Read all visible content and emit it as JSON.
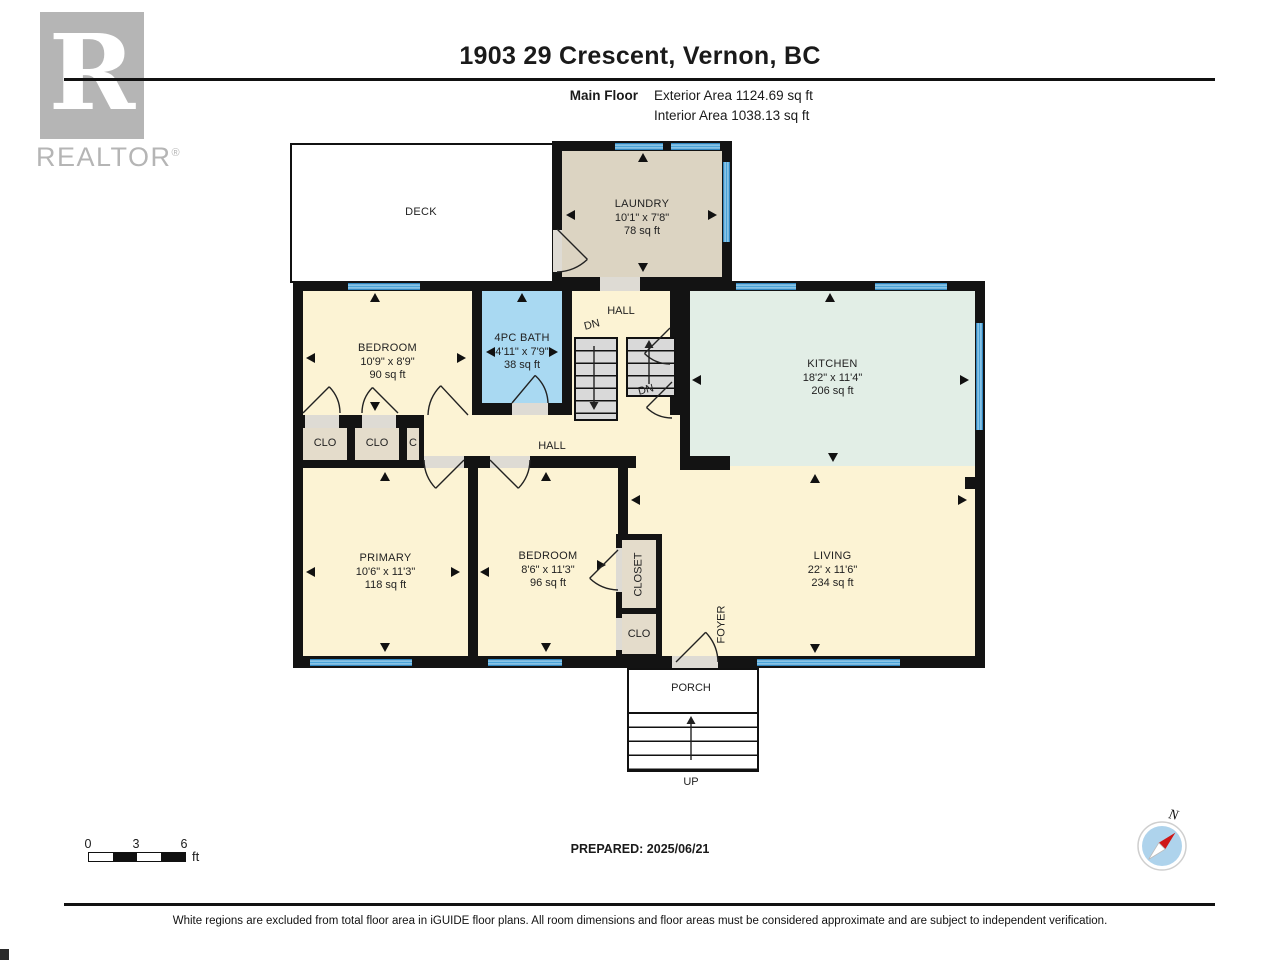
{
  "header": {
    "title": "1903 29 Crescent, Vernon, BC",
    "floor_label": "Main Floor",
    "exterior_area": "Exterior Area 1124.69 sq ft",
    "interior_area": "Interior Area 1038.13 sq ft",
    "brand": "REALTOR",
    "brand_reg": "®",
    "brand_letter": "R"
  },
  "rooms": {
    "deck": {
      "name": "DECK"
    },
    "laundry": {
      "name": "LAUNDRY",
      "dims": "10'1\" x 7'8\"",
      "area": "78 sq ft"
    },
    "bedroom1": {
      "name": "BEDROOM",
      "dims": "10'9\" x 8'9\"",
      "area": "90 sq ft"
    },
    "bath": {
      "name": "4PC BATH",
      "dims": "4'11\" x 7'9\"",
      "area": "38 sq ft"
    },
    "kitchen": {
      "name": "KITCHEN",
      "dims": "18'2\" x 11'4\"",
      "area": "206 sq ft"
    },
    "primary": {
      "name": "PRIMARY",
      "dims": "10'6\" x 11'3\"",
      "area": "118 sq ft"
    },
    "bedroom2": {
      "name": "BEDROOM",
      "dims": "8'6\" x 11'3\"",
      "area": "96 sq ft"
    },
    "living": {
      "name": "LIVING",
      "dims": "22' x 11'6\"",
      "area": "234 sq ft"
    },
    "porch": {
      "name": "PORCH"
    }
  },
  "labels": {
    "hall_upper": "HALL",
    "hall_main": "HALL",
    "dn_upper": "DN",
    "dn_lower": "DN",
    "up": "UP",
    "clo_a": "CLO",
    "clo_b": "CLO",
    "c_small": "C",
    "closet": "CLOSET",
    "clo_c": "CLO",
    "foyer": "FOYER"
  },
  "scalebar": {
    "tick0": "0",
    "tick1": "3",
    "tick2": "6",
    "unit": "ft"
  },
  "footer": {
    "prepared": "PREPARED: 2025/06/21",
    "compass_n": "N",
    "disclaimer": "White regions are excluded from total floor area in iGUIDE floor plans. All room dimensions and floor areas must be considered approximate and are subject to independent verification."
  },
  "colors": {
    "wall_black": "#131313",
    "room_cream": "#fcf3d4",
    "room_mint": "#e2eee6",
    "room_blue": "#a9d9f2",
    "room_tan": "#dcd4c2",
    "closet_tan": "#e4dccb",
    "window_blue": "#4aa3d8",
    "stair_gray": "#d9d9d9",
    "compass_blue": "#aed3ec",
    "compass_red": "#cf1717"
  }
}
